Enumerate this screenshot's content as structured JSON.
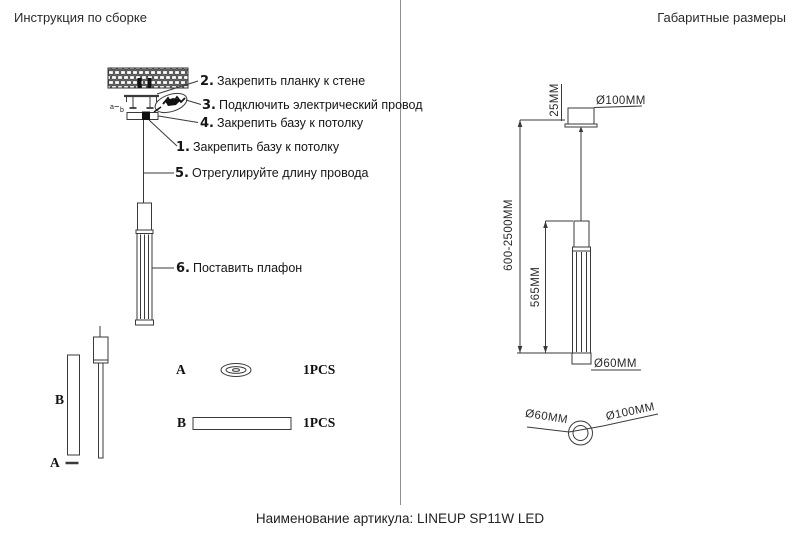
{
  "page": {
    "header_left": "Инструкция по сборке",
    "header_right": "Габаритные размеры",
    "footer": "Наименование артикула: LINEUP SP11W LED"
  },
  "assembly": {
    "steps": [
      {
        "num": "1.",
        "text": "Закрепить базу к потолку"
      },
      {
        "num": "2.",
        "text": "Закрепить планку к стене"
      },
      {
        "num": "3.",
        "text": "Подключить электрический провод"
      },
      {
        "num": "4.",
        "text": "Закрепить базу к потолку"
      },
      {
        "num": "5.",
        "text": "Отрегулируйте длину провода"
      },
      {
        "num": "6.",
        "text": "Поставить плафон"
      }
    ],
    "mount_marks": {
      "a": "a",
      "b": "b"
    },
    "exploded": {
      "label_a": "A",
      "label_b": "B"
    },
    "parts": [
      {
        "key": "A",
        "qty": "1PCS",
        "shape": "ring"
      },
      {
        "key": "B",
        "qty": "1PCS",
        "shape": "bar"
      }
    ]
  },
  "dimensions": {
    "canopy_height": "25MM",
    "canopy_diameter": "Ø100MM",
    "suspension_range": "600-2500MM",
    "shade_height": "565MM",
    "shade_diameter": "Ø60MM",
    "bottom_view_inner": "Ø60MM",
    "bottom_view_outer": "Ø100MM"
  },
  "colors": {
    "line": "#3a3a3a",
    "ink": "#111111",
    "divider": "#8f8f8f"
  }
}
